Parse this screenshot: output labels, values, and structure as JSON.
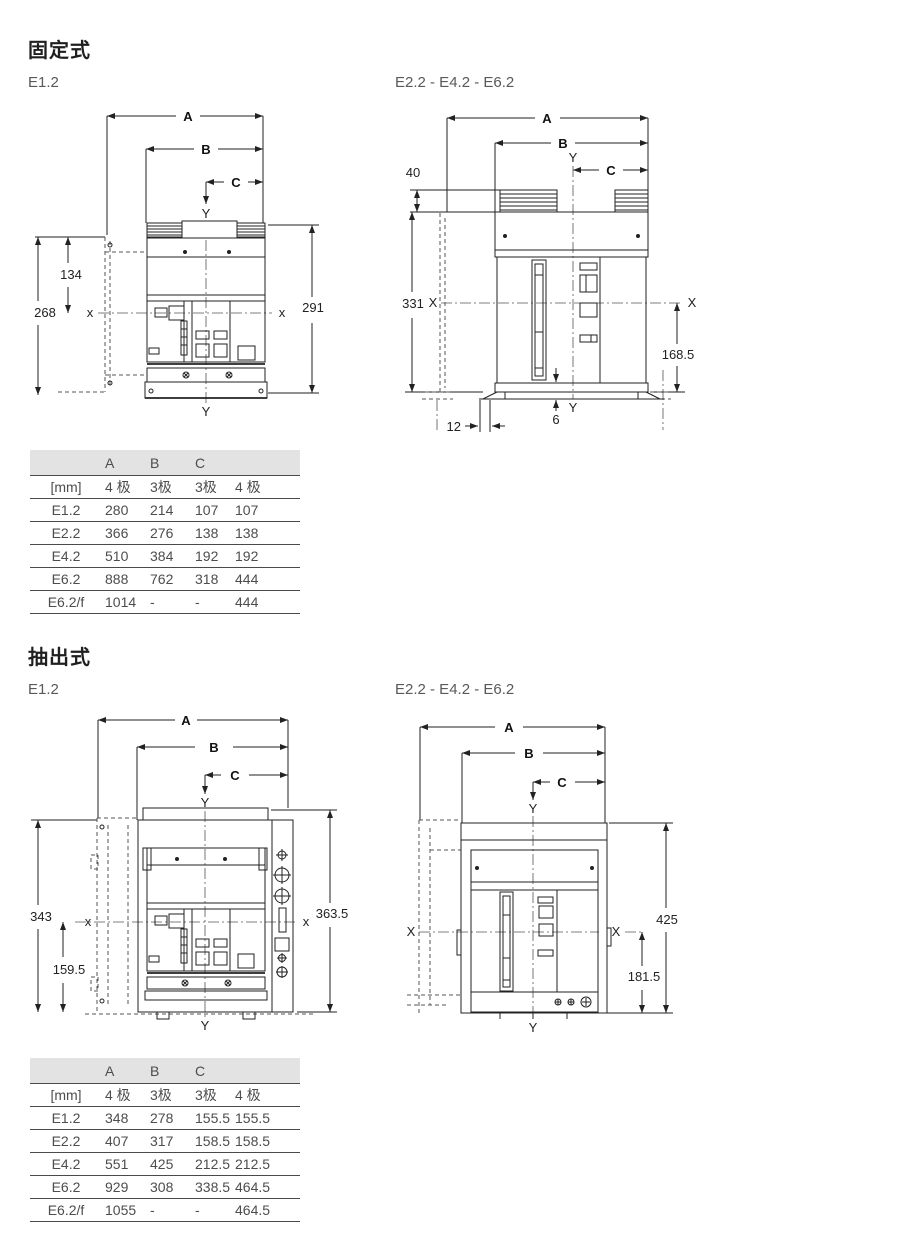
{
  "page": {
    "background": "#ffffff"
  },
  "sections": [
    {
      "title": "固定式",
      "drawings": [
        {
          "label": "E1.2",
          "dim_a": "A",
          "dim_b": "B",
          "dim_c": "C",
          "axis_x": "x",
          "axis_y": "Y",
          "d_upper": "134",
          "d_total": "268",
          "d_right": "291"
        },
        {
          "label": "E2.2 - E4.2 - E6.2",
          "dim_a": "A",
          "dim_b": "B",
          "dim_c": "C",
          "axis_x": "X",
          "axis_y": "Y",
          "d_terminal": "40",
          "d_height": "331",
          "d_lower": "168.5",
          "d_gap": "6",
          "d_foot": "12"
        }
      ],
      "table": {
        "header_top": [
          "",
          "A",
          "B",
          "C",
          ""
        ],
        "header_sub": [
          "[mm]",
          "4 极",
          "3极",
          "3极",
          "4 极"
        ],
        "rows": [
          [
            "E1.2",
            "280",
            "214",
            "107",
            "107"
          ],
          [
            "E2.2",
            "366",
            "276",
            "138",
            "138"
          ],
          [
            "E4.2",
            "510",
            "384",
            "192",
            "192"
          ],
          [
            "E6.2",
            "888",
            "762",
            "318",
            "444"
          ],
          [
            "E6.2/f",
            "1014",
            "-",
            "-",
            "444"
          ]
        ]
      }
    },
    {
      "title": "抽出式",
      "drawings": [
        {
          "label": "E1.2",
          "dim_a": "A",
          "dim_b": "B",
          "dim_c": "C",
          "axis_x": "x",
          "axis_y": "Y",
          "d_total": "343",
          "d_lower": "159.5",
          "d_right": "363.5"
        },
        {
          "label": "E2.2 - E4.2 - E6.2",
          "dim_a": "A",
          "dim_b": "B",
          "dim_c": "C",
          "axis_x": "X",
          "axis_y": "Y",
          "d_right": "425",
          "d_lower": "181.5"
        }
      ],
      "table": {
        "header_top": [
          "",
          "A",
          "B",
          "C",
          ""
        ],
        "header_sub": [
          "[mm]",
          "4 极",
          "3极",
          "3极",
          "4 极"
        ],
        "rows": [
          [
            "E1.2",
            "348",
            "278",
            "155.5",
            "155.5"
          ],
          [
            "E2.2",
            "407",
            "317",
            "158.5",
            "158.5"
          ],
          [
            "E4.2",
            "551",
            "425",
            "212.5",
            "212.5"
          ],
          [
            "E6.2",
            "929",
            "308",
            "338.5",
            "464.5"
          ],
          [
            "E6.2/f",
            "1055",
            "-",
            "-",
            "464.5"
          ]
        ]
      }
    }
  ]
}
